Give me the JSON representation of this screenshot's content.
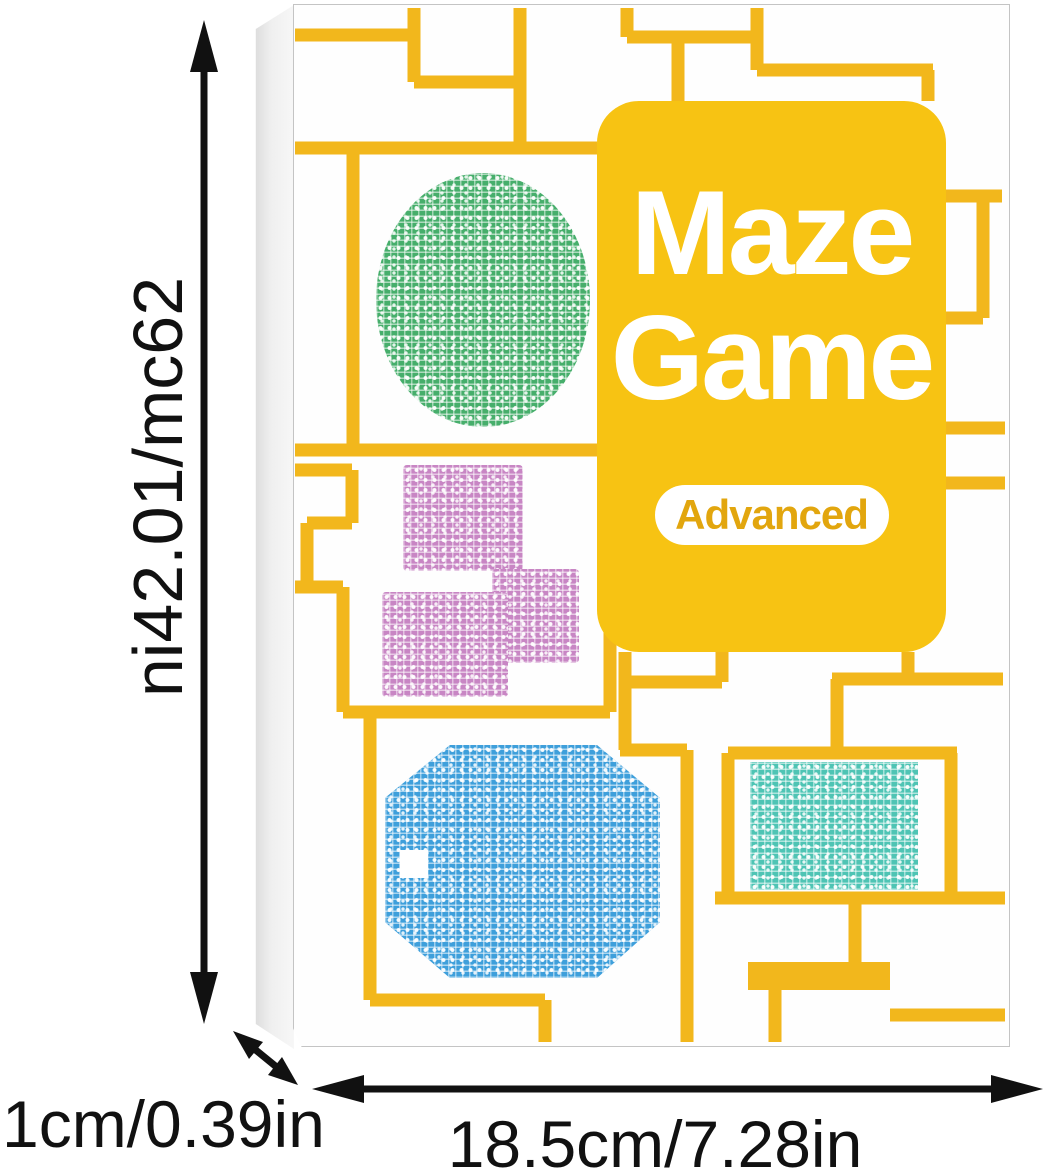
{
  "box": {
    "title_line1": "Maze",
    "title_line2": "Game",
    "badge": "Advanced"
  },
  "dimensions": {
    "height": "26cm/10.24in",
    "depth": "1cm/0.39in",
    "width": "18.5cm/7.28in"
  },
  "icons": {
    "height_arrow": "double-arrow-vertical",
    "depth_arrow": "double-arrow-diagonal",
    "width_arrow": "double-arrow-horizontal"
  },
  "colors": {
    "path_yellow": "#F2B71C",
    "card_yellow": "#F7C313",
    "badge_text_yellow": "#E2A60E",
    "maze_green": "#46AE6B",
    "maze_purple": "#C886C4",
    "maze_blue": "#3E9FDB",
    "maze_teal": "#4EC4B4",
    "arrow_black": "#111111",
    "dimension_text": "#111111"
  }
}
